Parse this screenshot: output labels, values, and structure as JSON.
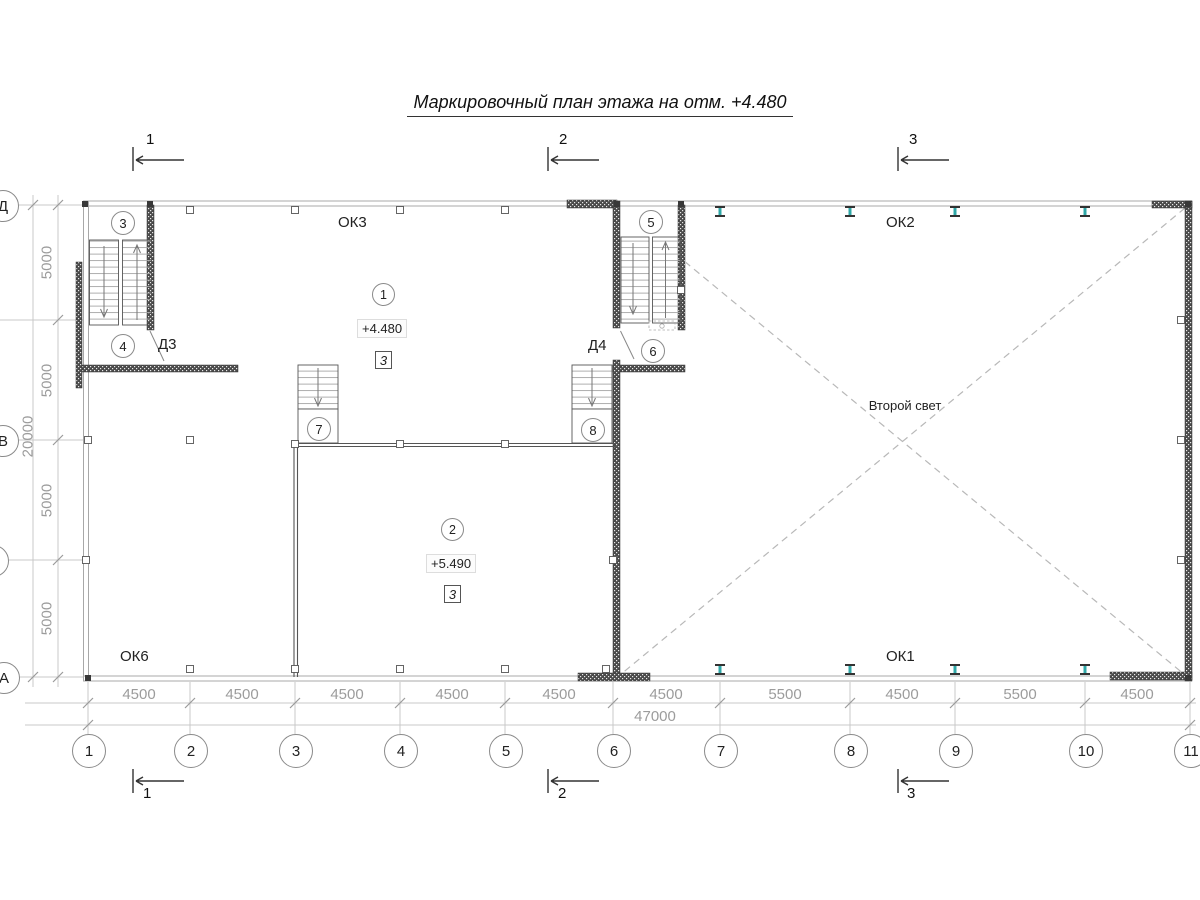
{
  "title": "Маркировочный план этажа на отм. +4.480",
  "sections": {
    "s1": "1",
    "s2": "2",
    "s3": "3"
  },
  "grid": {
    "cols": [
      "1",
      "2",
      "3",
      "4",
      "5",
      "6",
      "7",
      "8",
      "9",
      "10",
      "11"
    ],
    "rows": [
      "Д",
      "Г",
      "В",
      "Б",
      "А"
    ]
  },
  "dims": {
    "bottom": [
      "4500",
      "4500",
      "4500",
      "4500",
      "4500",
      "4500",
      "5500",
      "4500",
      "5500",
      "4500"
    ],
    "bottom_total": "47000",
    "left": [
      "5000",
      "5000",
      "5000",
      "5000"
    ],
    "left_total": "20000"
  },
  "labels": {
    "ok3": "ОК3",
    "ok2": "ОК2",
    "ok6": "ОК6",
    "ok1": "ОК1",
    "d3": "Д3",
    "d4": "Д4",
    "second_light": "Второй свет"
  },
  "marks": {
    "m3": "3",
    "m4": "4",
    "m5": "5",
    "m6": "6",
    "m7": "7",
    "m8": "8"
  },
  "rooms": {
    "room1": {
      "num": "1",
      "elev": "+4.480",
      "type": "3"
    },
    "room2": {
      "num": "2",
      "elev": "+5.490",
      "type": "3"
    }
  },
  "colors": {
    "beam_accent": "#2FA8A8"
  }
}
